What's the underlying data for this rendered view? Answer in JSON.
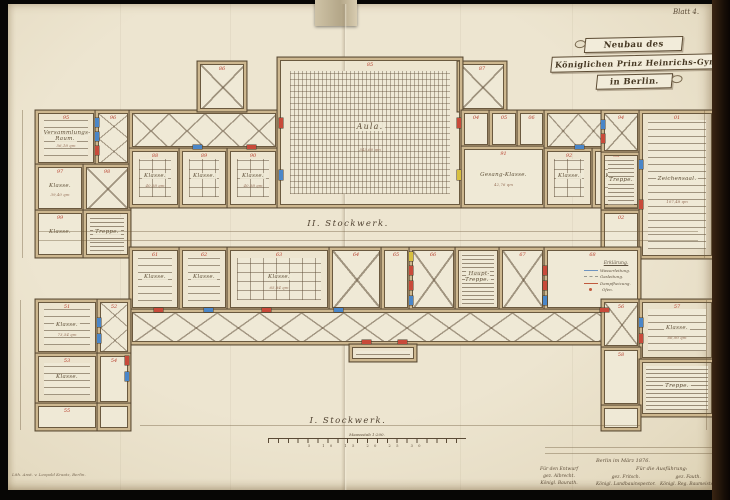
{
  "sheet": {
    "label": "Blatt 4."
  },
  "title": {
    "line1": "Neubau des",
    "line2": "Königlichen Prinz Heinrichs-Gymnasiums",
    "line3": "in Berlin."
  },
  "floors": {
    "upper": "II. Stockwerk.",
    "lower": "I. Stockwerk."
  },
  "legend": {
    "title": "Erklärung.",
    "items": [
      {
        "color": "#6f94c0",
        "style": "solid",
        "label": "Wasserleitung."
      },
      {
        "color": "#9a9a92",
        "style": "dashed",
        "label": "Gasleitung."
      },
      {
        "color": "#c05a3e",
        "style": "solid",
        "label": "Dampfheizung."
      },
      {
        "color": "#c05a3e",
        "style": "dot",
        "label": "Ofen."
      }
    ]
  },
  "scalebar": {
    "caption": "Maassstab 1:200.",
    "numbers": "5 10 15 20 25 30"
  },
  "signatures": {
    "place_date": "Berlin im März 1876.",
    "execution_header": "Für die Ausführung:",
    "design_header": "Für den Entwurf",
    "design_name": "gez. Albrecht.",
    "design_title": "Königl. Baurath.",
    "exec1_name": "gez. Fritsch.",
    "exec1_title": "Königl. Landbauinspector.",
    "exec2_name": "gez. Fauth.",
    "exec2_title": "Königl. Reg. Baumeister."
  },
  "credit": {
    "text": "Lith. Anst. v. Leopold Kraatz, Berlin."
  },
  "colors": {
    "paper": "#ece4cf",
    "wall_fill": "#cdb78f",
    "wall_line": "#5a4a33",
    "ink_red": "#b8402e",
    "fixture_blue": "#4a86c8",
    "fixture_red": "#c84a3a",
    "fixture_yellow": "#d8c040"
  },
  "plans": {
    "upper": {
      "rooms": [
        {
          "x": 38,
          "y": 113,
          "w": 56,
          "h": 50,
          "p": "benches",
          "num": "95",
          "name": "Versammlungs-Raum.",
          "dims": "56,18 qm"
        },
        {
          "x": 98,
          "y": 113,
          "w": 30,
          "h": 50,
          "p": "x",
          "bx": 1,
          "by": 2,
          "num": "96"
        },
        {
          "x": 38,
          "y": 167,
          "w": 44,
          "h": 42,
          "num": "97",
          "name": "Klasse.",
          "dims": "39,40 qm"
        },
        {
          "x": 86,
          "y": 167,
          "w": 42,
          "h": 42,
          "p": "x",
          "bx": 1,
          "by": 1,
          "num": "98"
        },
        {
          "x": 38,
          "y": 213,
          "w": 44,
          "h": 42,
          "num": "99",
          "name": "Klasse."
        },
        {
          "x": 86,
          "y": 213,
          "w": 42,
          "h": 42,
          "p": "stairs",
          "name": "Treppe."
        },
        {
          "x": 132,
          "y": 113,
          "w": 144,
          "h": 34,
          "p": "x",
          "bx": 4,
          "by": 1
        },
        {
          "x": 132,
          "y": 151,
          "w": 46,
          "h": 54,
          "p": "grid",
          "num": "88",
          "name": "Klasse.",
          "dims": "40,58 qm"
        },
        {
          "x": 182,
          "y": 151,
          "w": 44,
          "h": 54,
          "p": "grid",
          "num": "89",
          "name": "Klasse."
        },
        {
          "x": 230,
          "y": 151,
          "w": 46,
          "h": 54,
          "p": "grid",
          "num": "90",
          "name": "Klasse.",
          "dims": "40,58 qm"
        },
        {
          "x": 200,
          "y": 64,
          "w": 44,
          "h": 45,
          "p": "x",
          "bx": 1,
          "by": 1,
          "num": "86"
        },
        {
          "x": 460,
          "y": 64,
          "w": 44,
          "h": 45,
          "p": "x",
          "bx": 1,
          "by": 1,
          "num": "87"
        },
        {
          "x": 280,
          "y": 60,
          "w": 180,
          "h": 145,
          "p": "aula",
          "num": "85",
          "name": "Aula.",
          "dims": "343,60 qm",
          "big": true
        },
        {
          "x": 464,
          "y": 113,
          "w": 24,
          "h": 32,
          "num": "04"
        },
        {
          "x": 492,
          "y": 113,
          "w": 24,
          "h": 32,
          "num": "05"
        },
        {
          "x": 520,
          "y": 113,
          "w": 23,
          "h": 32,
          "num": "06"
        },
        {
          "x": 464,
          "y": 149,
          "w": 79,
          "h": 56,
          "num": "91",
          "name": "Gesang-Klasse.",
          "dims": "42,76 qm"
        },
        {
          "x": 547,
          "y": 113,
          "w": 91,
          "h": 34,
          "p": "x",
          "bx": 3,
          "by": 1
        },
        {
          "x": 547,
          "y": 151,
          "w": 44,
          "h": 54,
          "p": "grid",
          "num": "92",
          "name": "Klasse."
        },
        {
          "x": 595,
          "y": 151,
          "w": 43,
          "h": 54,
          "p": "grid",
          "num": "93",
          "name": "Klasse."
        },
        {
          "x": 604,
          "y": 113,
          "w": 34,
          "h": 38,
          "p": "x",
          "bx": 1,
          "by": 1,
          "num": "94"
        },
        {
          "x": 604,
          "y": 155,
          "w": 34,
          "h": 54,
          "p": "stairs",
          "name": "Treppe."
        },
        {
          "x": 604,
          "y": 213,
          "w": 34,
          "h": 43,
          "num": "02"
        },
        {
          "x": 642,
          "y": 113,
          "w": 70,
          "h": 143,
          "p": "benches",
          "num": "01",
          "name": "Zeichensaal.",
          "dims": "107,48 qm"
        }
      ],
      "fixtures": [
        {
          "x": 95,
          "y": 118,
          "w": 4,
          "h": 9,
          "c": "#4a86c8"
        },
        {
          "x": 95,
          "y": 132,
          "w": 4,
          "h": 9,
          "c": "#4a86c8"
        },
        {
          "x": 95,
          "y": 146,
          "w": 4,
          "h": 9,
          "c": "#c84a3a"
        },
        {
          "x": 193,
          "y": 145,
          "w": 9,
          "h": 4,
          "c": "#4a86c8"
        },
        {
          "x": 247,
          "y": 145,
          "w": 9,
          "h": 4,
          "c": "#c84a3a"
        },
        {
          "x": 279,
          "y": 118,
          "w": 4,
          "h": 10,
          "c": "#c84a3a"
        },
        {
          "x": 279,
          "y": 170,
          "w": 4,
          "h": 10,
          "c": "#4a86c8"
        },
        {
          "x": 457,
          "y": 118,
          "w": 4,
          "h": 10,
          "c": "#c84a3a"
        },
        {
          "x": 457,
          "y": 170,
          "w": 4,
          "h": 10,
          "c": "#d8c040"
        },
        {
          "x": 575,
          "y": 145,
          "w": 9,
          "h": 4,
          "c": "#4a86c8"
        },
        {
          "x": 601,
          "y": 120,
          "w": 4,
          "h": 9,
          "c": "#4a86c8"
        },
        {
          "x": 601,
          "y": 134,
          "w": 4,
          "h": 9,
          "c": "#c84a3a"
        },
        {
          "x": 639,
          "y": 160,
          "w": 4,
          "h": 9,
          "c": "#4a86c8"
        },
        {
          "x": 639,
          "y": 200,
          "w": 4,
          "h": 9,
          "c": "#c84a3a"
        }
      ]
    },
    "lower": {
      "rooms": [
        {
          "x": 132,
          "y": 250,
          "w": 46,
          "h": 58,
          "p": "benches",
          "num": "61",
          "name": "Klasse."
        },
        {
          "x": 182,
          "y": 250,
          "w": 44,
          "h": 58,
          "p": "benches",
          "num": "62",
          "name": "Klasse."
        },
        {
          "x": 230,
          "y": 250,
          "w": 98,
          "h": 58,
          "p": "grid",
          "num": "63",
          "name": "Klasse.",
          "dims": "65,84 qm"
        },
        {
          "x": 332,
          "y": 250,
          "w": 48,
          "h": 58,
          "p": "x",
          "bx": 1,
          "by": 1,
          "num": "64"
        },
        {
          "x": 384,
          "y": 250,
          "w": 24,
          "h": 58,
          "num": "65"
        },
        {
          "x": 412,
          "y": 250,
          "w": 42,
          "h": 58,
          "p": "x",
          "bx": 1,
          "by": 1,
          "num": "66"
        },
        {
          "x": 458,
          "y": 250,
          "w": 40,
          "h": 58,
          "p": "stairs",
          "name": "Haupt-Treppe."
        },
        {
          "x": 502,
          "y": 250,
          "w": 41,
          "h": 58,
          "p": "x",
          "bx": 1,
          "by": 1,
          "num": "67"
        },
        {
          "x": 547,
          "y": 250,
          "w": 91,
          "h": 58,
          "num": "68"
        },
        {
          "x": 132,
          "y": 312,
          "w": 506,
          "h": 30,
          "p": "x",
          "bx": 12,
          "by": 1
        },
        {
          "x": 352,
          "y": 347,
          "w": 62,
          "h": 12,
          "p": "stairs"
        },
        {
          "x": 38,
          "y": 302,
          "w": 58,
          "h": 50,
          "p": "benches",
          "num": "51",
          "name": "Klasse.",
          "dims": "73,54 qm"
        },
        {
          "x": 100,
          "y": 302,
          "w": 28,
          "h": 50,
          "p": "x",
          "bx": 1,
          "by": 2,
          "num": "52"
        },
        {
          "x": 38,
          "y": 356,
          "w": 58,
          "h": 46,
          "p": "benches",
          "num": "53",
          "name": "Klasse."
        },
        {
          "x": 100,
          "y": 356,
          "w": 28,
          "h": 46,
          "num": "54"
        },
        {
          "x": 38,
          "y": 406,
          "w": 58,
          "h": 22,
          "num": "55"
        },
        {
          "x": 100,
          "y": 406,
          "w": 28,
          "h": 22
        },
        {
          "x": 604,
          "y": 302,
          "w": 34,
          "h": 44,
          "p": "x",
          "bx": 1,
          "by": 1,
          "num": "56"
        },
        {
          "x": 642,
          "y": 302,
          "w": 70,
          "h": 56,
          "p": "benches",
          "num": "57",
          "name": "Klasse.",
          "dims": "66,90 qm"
        },
        {
          "x": 604,
          "y": 350,
          "w": 34,
          "h": 54,
          "num": "58"
        },
        {
          "x": 642,
          "y": 362,
          "w": 70,
          "h": 52,
          "p": "stairs",
          "name": "Treppe."
        },
        {
          "x": 604,
          "y": 408,
          "w": 34,
          "h": 20
        }
      ],
      "fixtures": [
        {
          "x": 154,
          "y": 308,
          "w": 9,
          "h": 4,
          "c": "#c84a3a"
        },
        {
          "x": 204,
          "y": 308,
          "w": 9,
          "h": 4,
          "c": "#4a86c8"
        },
        {
          "x": 262,
          "y": 308,
          "w": 9,
          "h": 4,
          "c": "#c84a3a"
        },
        {
          "x": 334,
          "y": 308,
          "w": 9,
          "h": 4,
          "c": "#4a86c8"
        },
        {
          "x": 409,
          "y": 252,
          "w": 4,
          "h": 9,
          "c": "#d8c040"
        },
        {
          "x": 409,
          "y": 266,
          "w": 4,
          "h": 9,
          "c": "#c84a3a"
        },
        {
          "x": 409,
          "y": 281,
          "w": 4,
          "h": 9,
          "c": "#c84a3a"
        },
        {
          "x": 409,
          "y": 296,
          "w": 4,
          "h": 9,
          "c": "#4a86c8"
        },
        {
          "x": 543,
          "y": 266,
          "w": 4,
          "h": 9,
          "c": "#c84a3a"
        },
        {
          "x": 543,
          "y": 281,
          "w": 4,
          "h": 9,
          "c": "#c84a3a"
        },
        {
          "x": 543,
          "y": 296,
          "w": 4,
          "h": 9,
          "c": "#4a86c8"
        },
        {
          "x": 600,
          "y": 308,
          "w": 9,
          "h": 4,
          "c": "#c84a3a"
        },
        {
          "x": 97,
          "y": 318,
          "w": 4,
          "h": 9,
          "c": "#4a86c8"
        },
        {
          "x": 97,
          "y": 334,
          "w": 4,
          "h": 9,
          "c": "#4a86c8"
        },
        {
          "x": 125,
          "y": 356,
          "w": 4,
          "h": 9,
          "c": "#c84a3a"
        },
        {
          "x": 125,
          "y": 372,
          "w": 4,
          "h": 9,
          "c": "#4a86c8"
        },
        {
          "x": 639,
          "y": 318,
          "w": 4,
          "h": 9,
          "c": "#4a86c8"
        },
        {
          "x": 639,
          "y": 334,
          "w": 4,
          "h": 9,
          "c": "#c84a3a"
        },
        {
          "x": 362,
          "y": 340,
          "w": 9,
          "h": 4,
          "c": "#c84a3a"
        },
        {
          "x": 398,
          "y": 340,
          "w": 9,
          "h": 4,
          "c": "#c84a3a"
        }
      ]
    }
  }
}
